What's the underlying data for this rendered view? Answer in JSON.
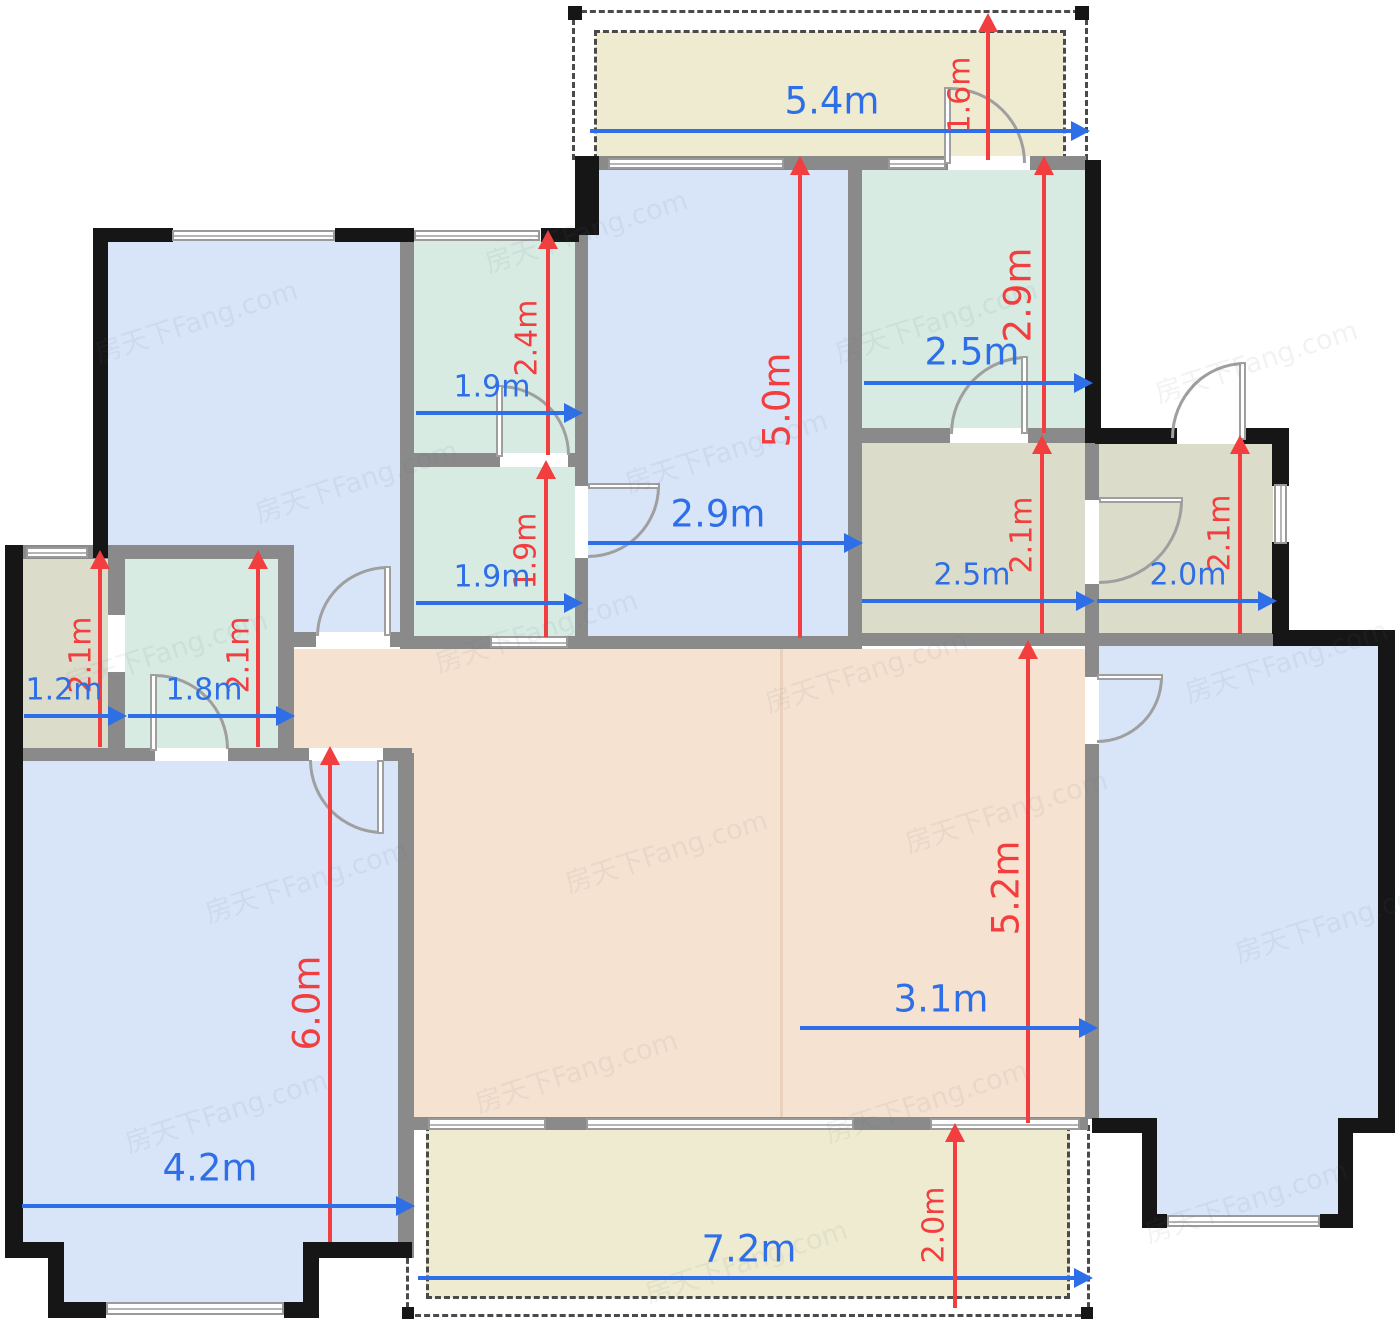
{
  "watermark": "房天下Fang.com",
  "colors": {
    "dimension_blue": "#2e6fe8",
    "dimension_red": "#f23e3e",
    "room_blue": "#d8e4f8",
    "room_teal": "#d7ebe3",
    "room_khaki": "#dcdccb",
    "room_salmon": "#f6e2d1",
    "balcony_beige": "#eeebd0",
    "wall_interior": "#8a8a8a",
    "wall_exterior": "#161616"
  },
  "rooms": [
    {
      "id": "balcony-top",
      "fill": "#eeebd0"
    },
    {
      "id": "bedroom-top-left",
      "fill": "#d8e4f8"
    },
    {
      "id": "small-room-upper",
      "fill": "#d7ebe3"
    },
    {
      "id": "small-room-lower",
      "fill": "#d7ebe3"
    },
    {
      "id": "room-center",
      "fill": "#d8e4f8"
    },
    {
      "id": "room-top-right",
      "fill": "#d7ebe3"
    },
    {
      "id": "utility-right-a",
      "fill": "#dcdccb"
    },
    {
      "id": "utility-right-b",
      "fill": "#dcdccb"
    },
    {
      "id": "utility-left-a",
      "fill": "#dcdccb"
    },
    {
      "id": "utility-left-b",
      "fill": "#d7ebe3"
    },
    {
      "id": "bedroom-bottom-left",
      "fill": "#d8e4f8"
    },
    {
      "id": "living-dining",
      "fill": "#f6e2d1"
    },
    {
      "id": "bedroom-right",
      "fill": "#d8e4f8"
    },
    {
      "id": "balcony-bottom",
      "fill": "#eeebd0"
    }
  ],
  "dimensions": {
    "balcony_top_width": "5.4m",
    "balcony_top_door": "1.6m",
    "room_center_depth": "5.0m",
    "room_center_width": "2.9m",
    "room_top_right_depth": "2.9m",
    "room_top_right_width": "2.5m",
    "small_upper_depth": "2.4m",
    "small_upper_width": "1.9m",
    "small_lower_depth": "1.9m",
    "small_lower_width": "1.9m",
    "utility_right_a_depth": "2.1m",
    "utility_right_a_width": "2.5m",
    "utility_right_b_depth": "2.1m",
    "utility_right_b_width": "2.0m",
    "utility_left_a_depth": "2.1m",
    "utility_left_a_width": "1.2m",
    "utility_left_b_depth": "2.1m",
    "utility_left_b_width": "1.8m",
    "bedroom_bottom_left_depth": "6.0m",
    "bedroom_bottom_left_width": "4.2m",
    "living_depth": "5.2m",
    "living_width": "3.1m",
    "balcony_bottom_width": "7.2m",
    "balcony_bottom_depth": "2.0m"
  }
}
